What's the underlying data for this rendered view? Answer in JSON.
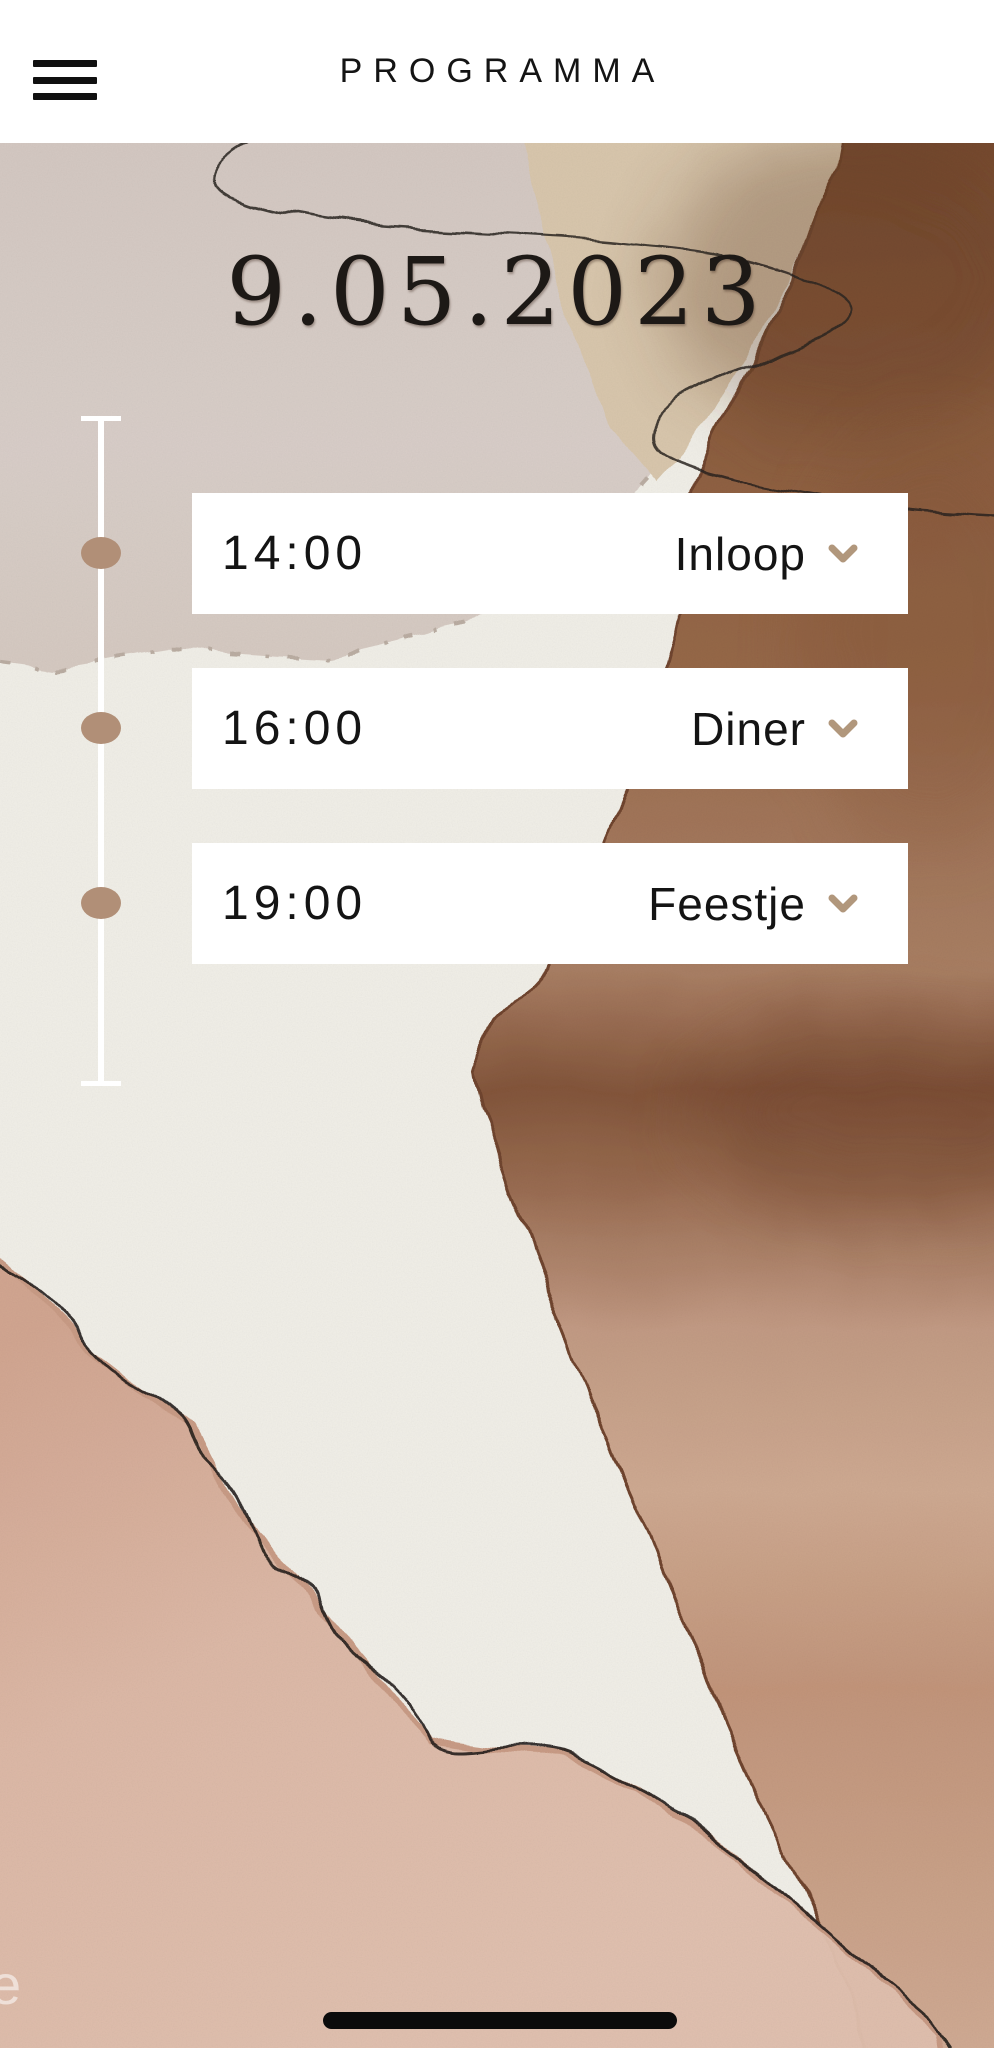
{
  "header": {
    "title": "PROGRAMMA",
    "menu_icon": "hamburger-menu-icon"
  },
  "hero": {
    "date": "9.05.2023"
  },
  "schedule": {
    "items": [
      {
        "time": "14:00",
        "label": "Inloop",
        "expand_icon": "chevron-down-icon"
      },
      {
        "time": "16:00",
        "label": "Diner",
        "expand_icon": "chevron-down-icon"
      },
      {
        "time": "19:00",
        "label": "Feestje",
        "expand_icon": "chevron-down-icon"
      }
    ]
  },
  "footer": {
    "watermark": "e",
    "home_indicator": "home-indicator-bar"
  },
  "colors": {
    "accent_tan": "#b18f77",
    "chevron_tan": "#b1977c",
    "card_bg": "#ffffff",
    "text": "#141414",
    "header_bg": "#ffffff",
    "paper": "#f0eee7",
    "brown_dark": "#6e4226",
    "brown_rose": "#cda78e",
    "pink": "#dcb6a4",
    "grey_pink": "#d7ccc6",
    "beige": "#d8c6ac"
  }
}
